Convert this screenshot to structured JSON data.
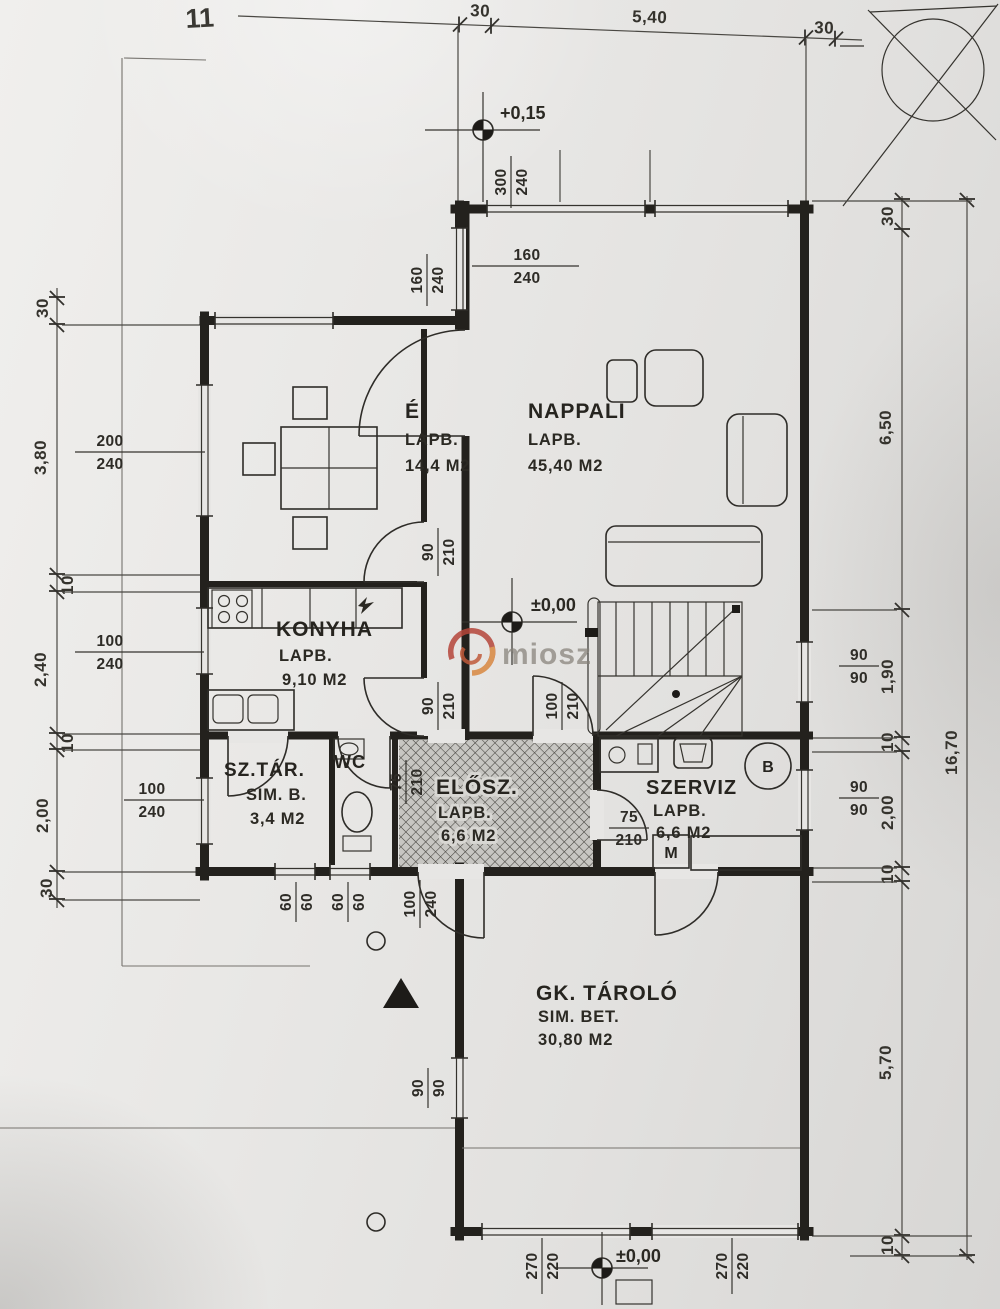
{
  "plot": {
    "number": "11"
  },
  "watermark": {
    "text": "miosz"
  },
  "rooms": {
    "etkezo": {
      "label": "É",
      "finish": "LAPB.",
      "area": "14,4 M2"
    },
    "nappali": {
      "label": "NAPPALI",
      "finish": "LAPB.",
      "area": "45,40 M2"
    },
    "konyha": {
      "label": "KONYHA",
      "finish": "LAPB.",
      "area": "9,10 M2"
    },
    "sztar": {
      "label": "SZ.TÁR.",
      "finish": "SIM. B.",
      "area": "3,4 M2"
    },
    "wc": {
      "label": "WC"
    },
    "elosz": {
      "label": "ELŐSZ.",
      "finish": "LAPB.",
      "area": "6,6 M2"
    },
    "szerviz": {
      "label": "SZERVIZ",
      "finish": "LAPB.",
      "area": "6,6 M2"
    },
    "gktarolo": {
      "label": "GK. TÁROLÓ",
      "finish": "SIM. BET.",
      "area": "30,80 M2"
    }
  },
  "levels": {
    "entry": "+0,15",
    "main": "±0,00",
    "outside": "±0,00"
  },
  "equipment": {
    "boiler": "B",
    "washer": "M"
  },
  "dimensions": {
    "top": {
      "d1": "30",
      "d2": "5,40",
      "d3": "30"
    },
    "left": {
      "d1": "30",
      "d2": "3,80",
      "d3": "10",
      "d4": "2,40",
      "d5": "10",
      "d6": "2,00",
      "d7": "30"
    },
    "right": {
      "d1": "30",
      "d2": "6,50",
      "d3": "1,90",
      "d4": "10",
      "d5": "2,00",
      "d6": "10",
      "d7": "5,70",
      "d8": "10",
      "total": "16,70"
    }
  },
  "openings": {
    "w300": {
      "w": "300",
      "h": "240"
    },
    "w160a": {
      "w": "160",
      "h": "240"
    },
    "w160b": {
      "w": "160",
      "h": "240"
    },
    "w200": {
      "w": "200",
      "h": "240"
    },
    "w100k": {
      "w": "100",
      "h": "240"
    },
    "w100s": {
      "w": "100",
      "h": "240"
    },
    "d90a": {
      "w": "90",
      "h": "210"
    },
    "d90b": {
      "w": "90",
      "h": "210"
    },
    "d100": {
      "w": "100",
      "h": "210"
    },
    "d75wc": {
      "w": "75",
      "h": "210"
    },
    "d75sz": {
      "w": "75",
      "h": "210"
    },
    "w60a": {
      "w": "60",
      "h": "60"
    },
    "w60b": {
      "w": "60",
      "h": "60"
    },
    "d100e": {
      "w": "100",
      "h": "240"
    },
    "w90r1": {
      "w": "90",
      "h": "90"
    },
    "w90r2": {
      "w": "90",
      "h": "90"
    },
    "w90g": {
      "w": "90",
      "h": "90"
    },
    "g270a": {
      "w": "270",
      "h": "220"
    },
    "g270b": {
      "w": "270",
      "h": "220"
    }
  }
}
